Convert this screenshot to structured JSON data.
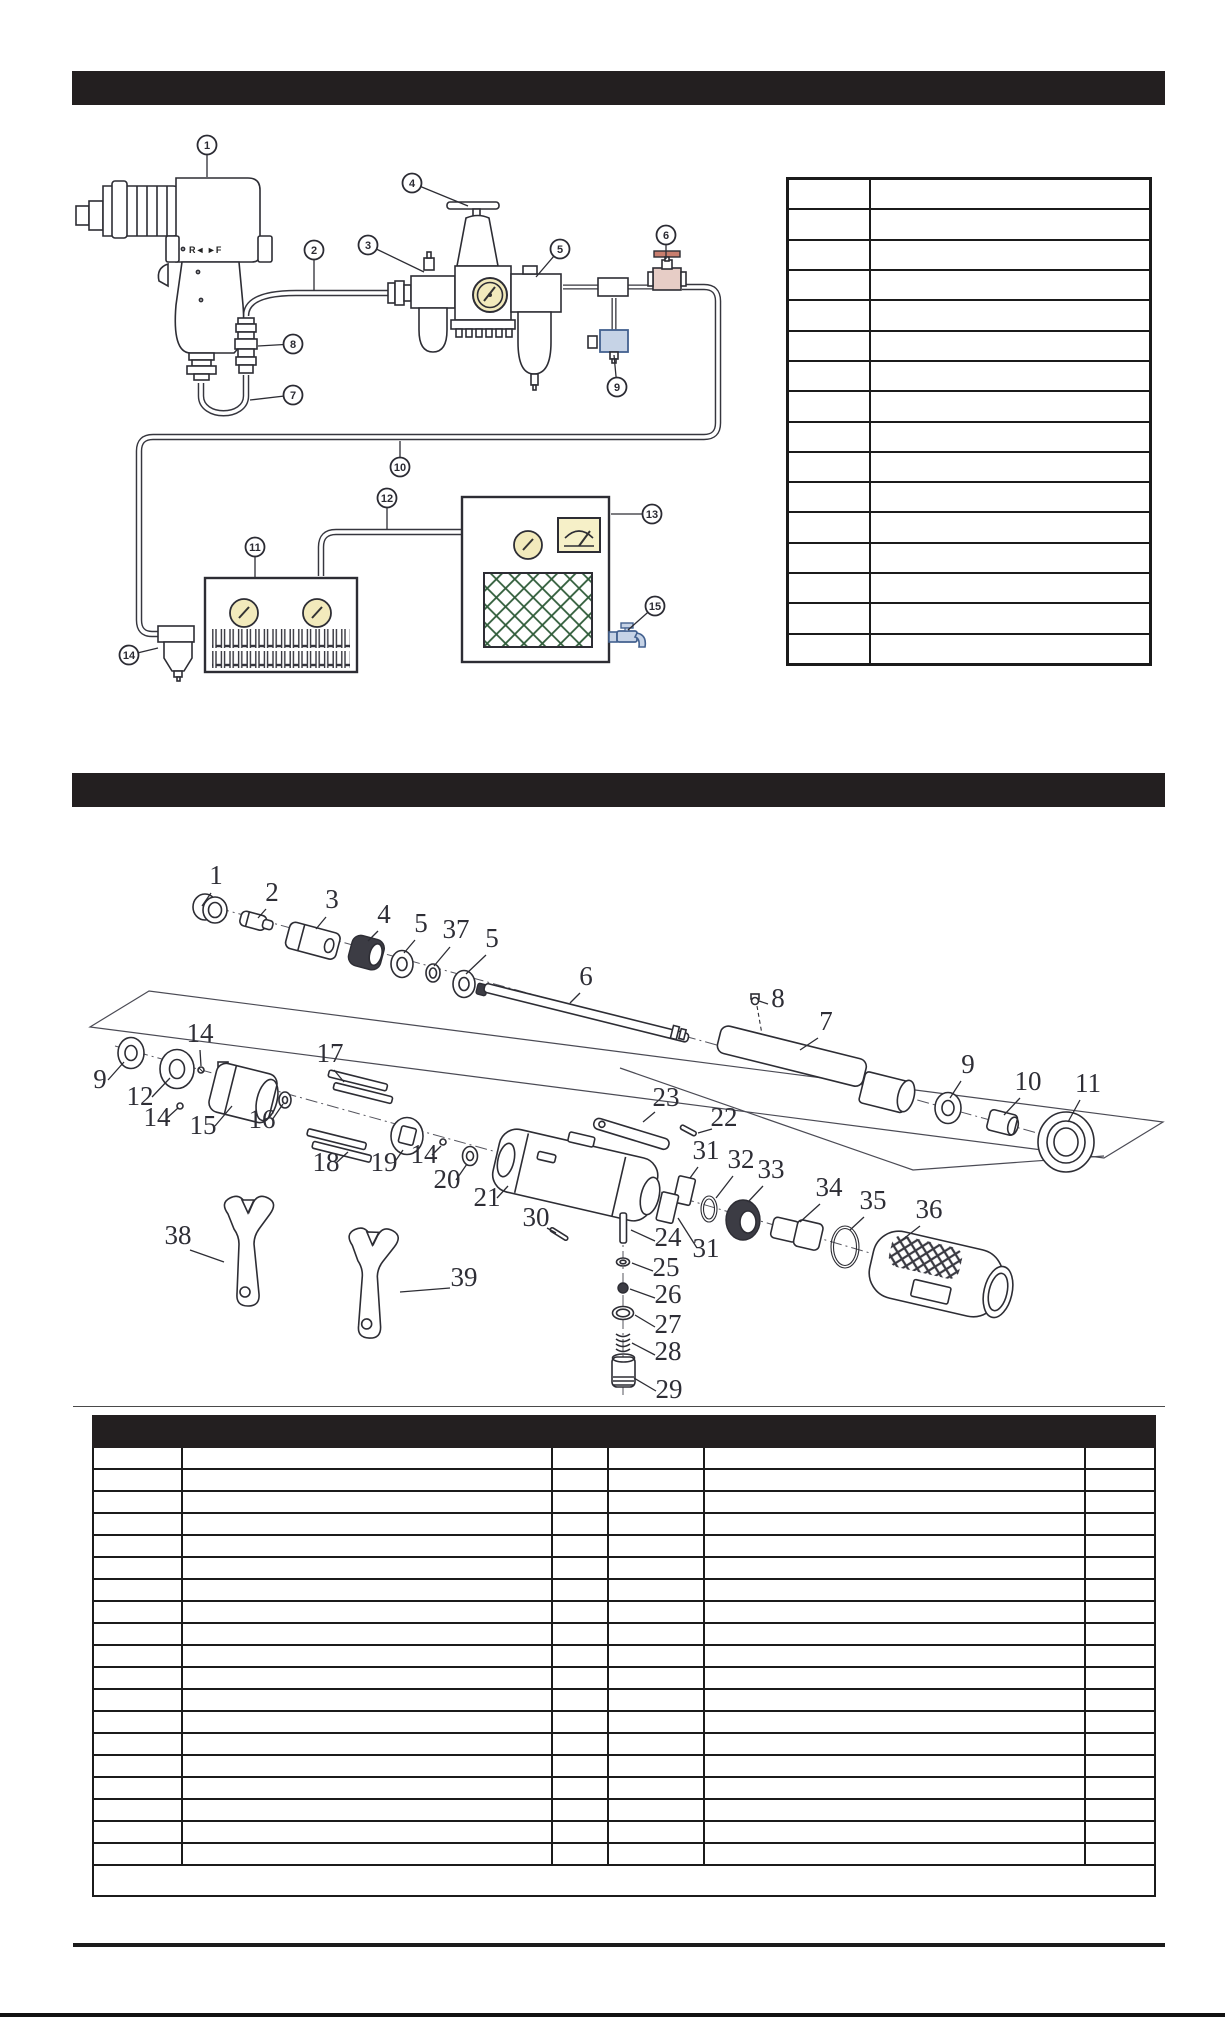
{
  "document": {
    "kind": "parts-manual-page",
    "section1_title": "",
    "section2_title": ""
  },
  "colors": {
    "bar_black": "#231f20",
    "ink": "#2d2d34",
    "table_border": "#1b1b1b",
    "gauge_yellow": "#f2eabc",
    "meter_yellow": "#f6f0c8",
    "grille_green": "#2f5c39",
    "valve_blue": "#43618f",
    "valve_blue_fill": "#c6d3e6",
    "valve_red": "#b06a5a",
    "valve_red_fill": "#e7cdc6",
    "dark_part": "#3c3c44"
  },
  "diagram1": {
    "tool_marking": "R◄  ►F",
    "callouts": [
      {
        "n": "1",
        "cx": 207,
        "cy": 145,
        "lx": 207,
        "ly": 177
      },
      {
        "n": "2",
        "cx": 314,
        "cy": 250,
        "lx": 314,
        "ly": 291
      },
      {
        "n": "3",
        "cx": 368,
        "cy": 245,
        "lx": 424,
        "ly": 272
      },
      {
        "n": "4",
        "cx": 412,
        "cy": 183,
        "lx": 468,
        "ly": 206
      },
      {
        "n": "5",
        "cx": 560,
        "cy": 249,
        "lx": 536,
        "ly": 277
      },
      {
        "n": "6",
        "cx": 666,
        "cy": 235,
        "lx": 666,
        "ly": 259
      },
      {
        "n": "7",
        "cx": 293,
        "cy": 395,
        "lx": 250,
        "ly": 400
      },
      {
        "n": "8",
        "cx": 293,
        "cy": 344,
        "lx": 258,
        "ly": 346
      },
      {
        "n": "9",
        "cx": 617,
        "cy": 387,
        "lx": 614,
        "ly": 355
      },
      {
        "n": "10",
        "cx": 400,
        "cy": 467,
        "lx": 400,
        "ly": 441
      },
      {
        "n": "11",
        "cx": 255,
        "cy": 547,
        "lx": 255,
        "ly": 577
      },
      {
        "n": "12",
        "cx": 387,
        "cy": 498,
        "lx": 387,
        "ly": 529
      },
      {
        "n": "13",
        "cx": 652,
        "cy": 514,
        "lx": 611,
        "ly": 514
      },
      {
        "n": "14",
        "cx": 129,
        "cy": 655,
        "lx": 158,
        "ly": 648
      },
      {
        "n": "15",
        "cx": 655,
        "cy": 606,
        "lx": 628,
        "ly": 630
      }
    ]
  },
  "diagram2": {
    "labels": [
      {
        "t": "1",
        "x": 216,
        "y": 884,
        "line": [
          211,
          893,
          202,
          906
        ]
      },
      {
        "t": "2",
        "x": 272,
        "y": 901,
        "line": [
          266,
          909,
          258,
          918
        ]
      },
      {
        "t": "3",
        "x": 332,
        "y": 908,
        "line": [
          326,
          917,
          316,
          929
        ]
      },
      {
        "t": "4",
        "x": 384,
        "y": 923,
        "line": [
          378,
          931,
          368,
          941
        ]
      },
      {
        "t": "5",
        "x": 421,
        "y": 932,
        "line": [
          415,
          940,
          404,
          953
        ]
      },
      {
        "t": "37",
        "x": 456,
        "y": 938,
        "line": [
          450,
          947,
          434,
          966
        ]
      },
      {
        "t": "5",
        "x": 492,
        "y": 947,
        "line": [
          486,
          955,
          466,
          974
        ]
      },
      {
        "t": "6",
        "x": 586,
        "y": 985,
        "line": [
          580,
          993,
          570,
          1003
        ]
      },
      {
        "t": "8",
        "x": 778,
        "y": 1007,
        "line": [
          768,
          1004,
          759,
          1001
        ]
      },
      {
        "t": "7",
        "x": 826,
        "y": 1030,
        "line": [
          818,
          1038,
          800,
          1050
        ]
      },
      {
        "t": "9",
        "x": 968,
        "y": 1073,
        "line": [
          961,
          1081,
          950,
          1098
        ]
      },
      {
        "t": "10",
        "x": 1028,
        "y": 1090,
        "line": [
          1020,
          1098,
          1004,
          1115
        ]
      },
      {
        "t": "11",
        "x": 1088,
        "y": 1092,
        "line": [
          1080,
          1100,
          1068,
          1122
        ]
      },
      {
        "t": "9",
        "x": 100,
        "y": 1088,
        "line": [
          108,
          1080,
          124,
          1062
        ]
      },
      {
        "t": "12",
        "x": 140,
        "y": 1105,
        "line": [
          152,
          1097,
          170,
          1078
        ]
      },
      {
        "t": "14",
        "x": 200,
        "y": 1042,
        "line": [
          200,
          1050,
          201,
          1066
        ]
      },
      {
        "t": "14",
        "x": 157,
        "y": 1126,
        "line": [
          167,
          1118,
          178,
          1108
        ]
      },
      {
        "t": "15",
        "x": 203,
        "y": 1134,
        "line": [
          215,
          1126,
          232,
          1106
        ]
      },
      {
        "t": "16",
        "x": 262,
        "y": 1128,
        "line": [
          272,
          1120,
          283,
          1104
        ]
      },
      {
        "t": "17",
        "x": 330,
        "y": 1062,
        "line": [
          334,
          1070,
          344,
          1082
        ]
      },
      {
        "t": "18",
        "x": 326,
        "y": 1171,
        "line": [
          336,
          1163,
          348,
          1152
        ]
      },
      {
        "t": "19",
        "x": 384,
        "y": 1171,
        "line": [
          394,
          1163,
          403,
          1150
        ]
      },
      {
        "t": "14",
        "x": 424,
        "y": 1163,
        "line": [
          432,
          1155,
          441,
          1146
        ]
      },
      {
        "t": "20",
        "x": 447,
        "y": 1188,
        "line": [
          456,
          1180,
          467,
          1164
        ]
      },
      {
        "t": "21",
        "x": 487,
        "y": 1206,
        "line": [
          497,
          1198,
          508,
          1186
        ]
      },
      {
        "t": "23",
        "x": 666,
        "y": 1106,
        "line": [
          655,
          1112,
          643,
          1122
        ]
      },
      {
        "t": "22",
        "x": 724,
        "y": 1126,
        "line": [
          712,
          1129,
          698,
          1133
        ]
      },
      {
        "t": "30",
        "x": 536,
        "y": 1226,
        "line": [
          547,
          1228,
          556,
          1233
        ]
      },
      {
        "t": "31",
        "x": 706,
        "y": 1159,
        "line": [
          698,
          1167,
          690,
          1178
        ]
      },
      {
        "t": "32",
        "x": 741,
        "y": 1168,
        "line": [
          733,
          1176,
          716,
          1198
        ]
      },
      {
        "t": "33",
        "x": 771,
        "y": 1178,
        "line": [
          763,
          1186,
          748,
          1202
        ]
      },
      {
        "t": "34",
        "x": 829,
        "y": 1196,
        "line": [
          820,
          1204,
          800,
          1222
        ]
      },
      {
        "t": "35",
        "x": 873,
        "y": 1209,
        "line": [
          864,
          1217,
          850,
          1230
        ]
      },
      {
        "t": "36",
        "x": 929,
        "y": 1218,
        "line": [
          920,
          1226,
          902,
          1240
        ]
      },
      {
        "t": "31",
        "x": 706,
        "y": 1257,
        "line": [
          697,
          1248,
          678,
          1218
        ]
      },
      {
        "t": "24",
        "x": 668,
        "y": 1246,
        "line": [
          655,
          1241,
          631,
          1230
        ]
      },
      {
        "t": "25",
        "x": 666,
        "y": 1276,
        "line": [
          653,
          1271,
          632,
          1263
        ]
      },
      {
        "t": "26",
        "x": 668,
        "y": 1303,
        "line": [
          655,
          1298,
          630,
          1289
        ]
      },
      {
        "t": "27",
        "x": 668,
        "y": 1333,
        "line": [
          655,
          1327,
          635,
          1315
        ]
      },
      {
        "t": "28",
        "x": 668,
        "y": 1360,
        "line": [
          655,
          1355,
          632,
          1343
        ]
      },
      {
        "t": "29",
        "x": 669,
        "y": 1398,
        "line": [
          656,
          1391,
          634,
          1378
        ]
      },
      {
        "t": "38",
        "x": 178,
        "y": 1244,
        "line": [
          190,
          1250,
          224,
          1262
        ]
      },
      {
        "t": "39",
        "x": 464,
        "y": 1286,
        "line": [
          450,
          1288,
          400,
          1292
        ]
      }
    ]
  },
  "table1": {
    "rows": 16,
    "cols": 2
  },
  "parts_table": {
    "rows": 19,
    "cols": 6,
    "note_rows": 1
  }
}
